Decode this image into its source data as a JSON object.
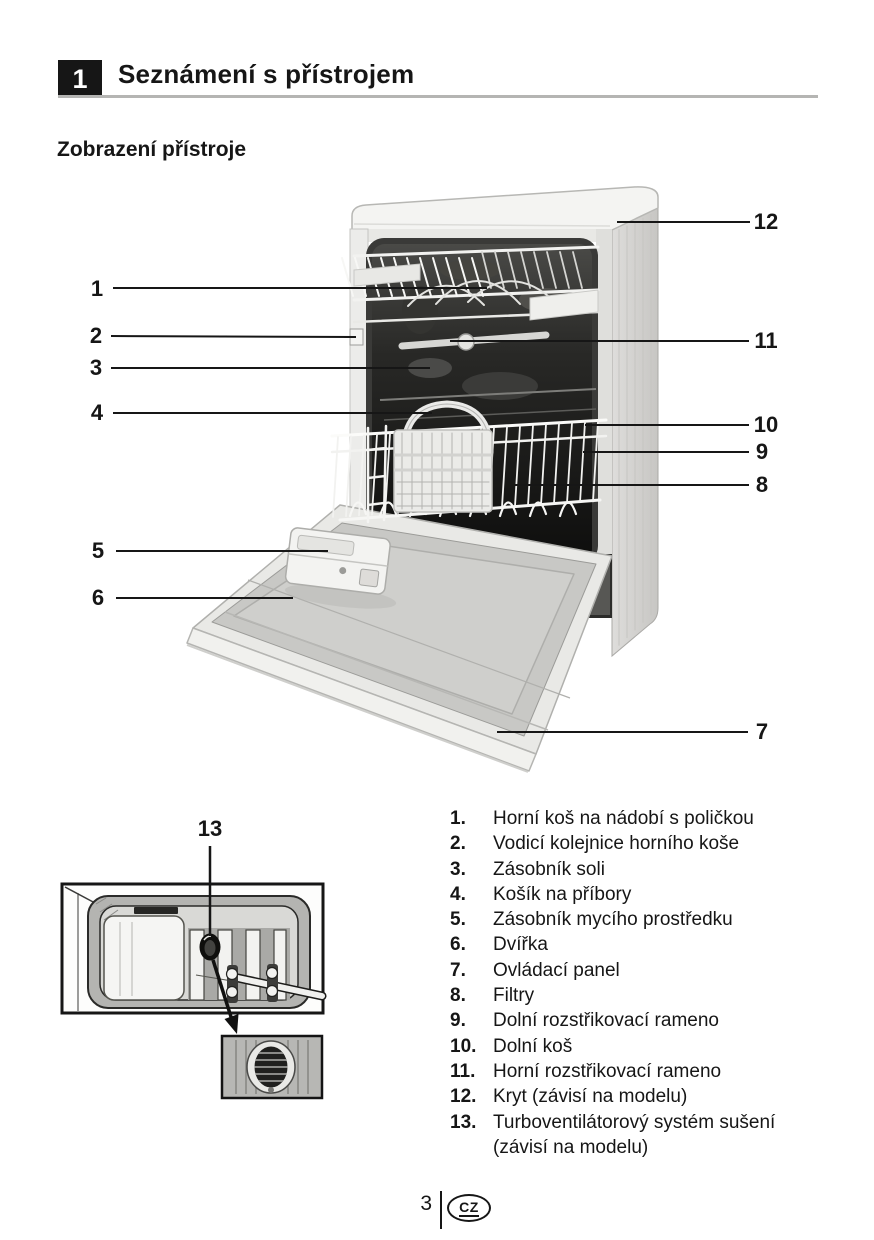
{
  "header": {
    "section_number": "1",
    "title": "Seznámení s přístrojem",
    "subtitle": "Zobrazení přístroje"
  },
  "callouts": {
    "c1": "1",
    "c2": "2",
    "c3": "3",
    "c4": "4",
    "c5": "5",
    "c6": "6",
    "c7": "7",
    "c8": "8",
    "c9": "9",
    "c10": "10",
    "c11": "11",
    "c12": "12",
    "c13": "13"
  },
  "parts_list": {
    "items": [
      {
        "num": "1.",
        "label": "Horní koš na nádobí s poličkou"
      },
      {
        "num": "2.",
        "label": "Vodicí kolejnice horního koše"
      },
      {
        "num": "3.",
        "label": "Zásobník soli"
      },
      {
        "num": "4.",
        "label": "Košík na příbory"
      },
      {
        "num": "5.",
        "label": "Zásobník mycího prostředku"
      },
      {
        "num": "6.",
        "label": "Dvířka"
      },
      {
        "num": "7.",
        "label": "Ovládací panel"
      },
      {
        "num": "8.",
        "label": "Filtry"
      },
      {
        "num": "9.",
        "label": "Dolní rozstřikovací rameno"
      },
      {
        "num": "10.",
        "label": "Dolní koš"
      },
      {
        "num": "11.",
        "label": "Horní rozstřikovací rameno"
      },
      {
        "num": "12.",
        "label": "Kryt (závisí na modelu)"
      },
      {
        "num": "13.",
        "label": "Turboventilátorový systém sušení",
        "label2": "(závisí na modelu)"
      }
    ]
  },
  "footer": {
    "page_number": "3",
    "country_code": "CZ"
  },
  "colors": {
    "ink": "#161616",
    "header_box": "#161616",
    "header_rule": "#b5b5b3",
    "photo_midgray": "#c8c8c5",
    "tub_dark": "#111110"
  }
}
